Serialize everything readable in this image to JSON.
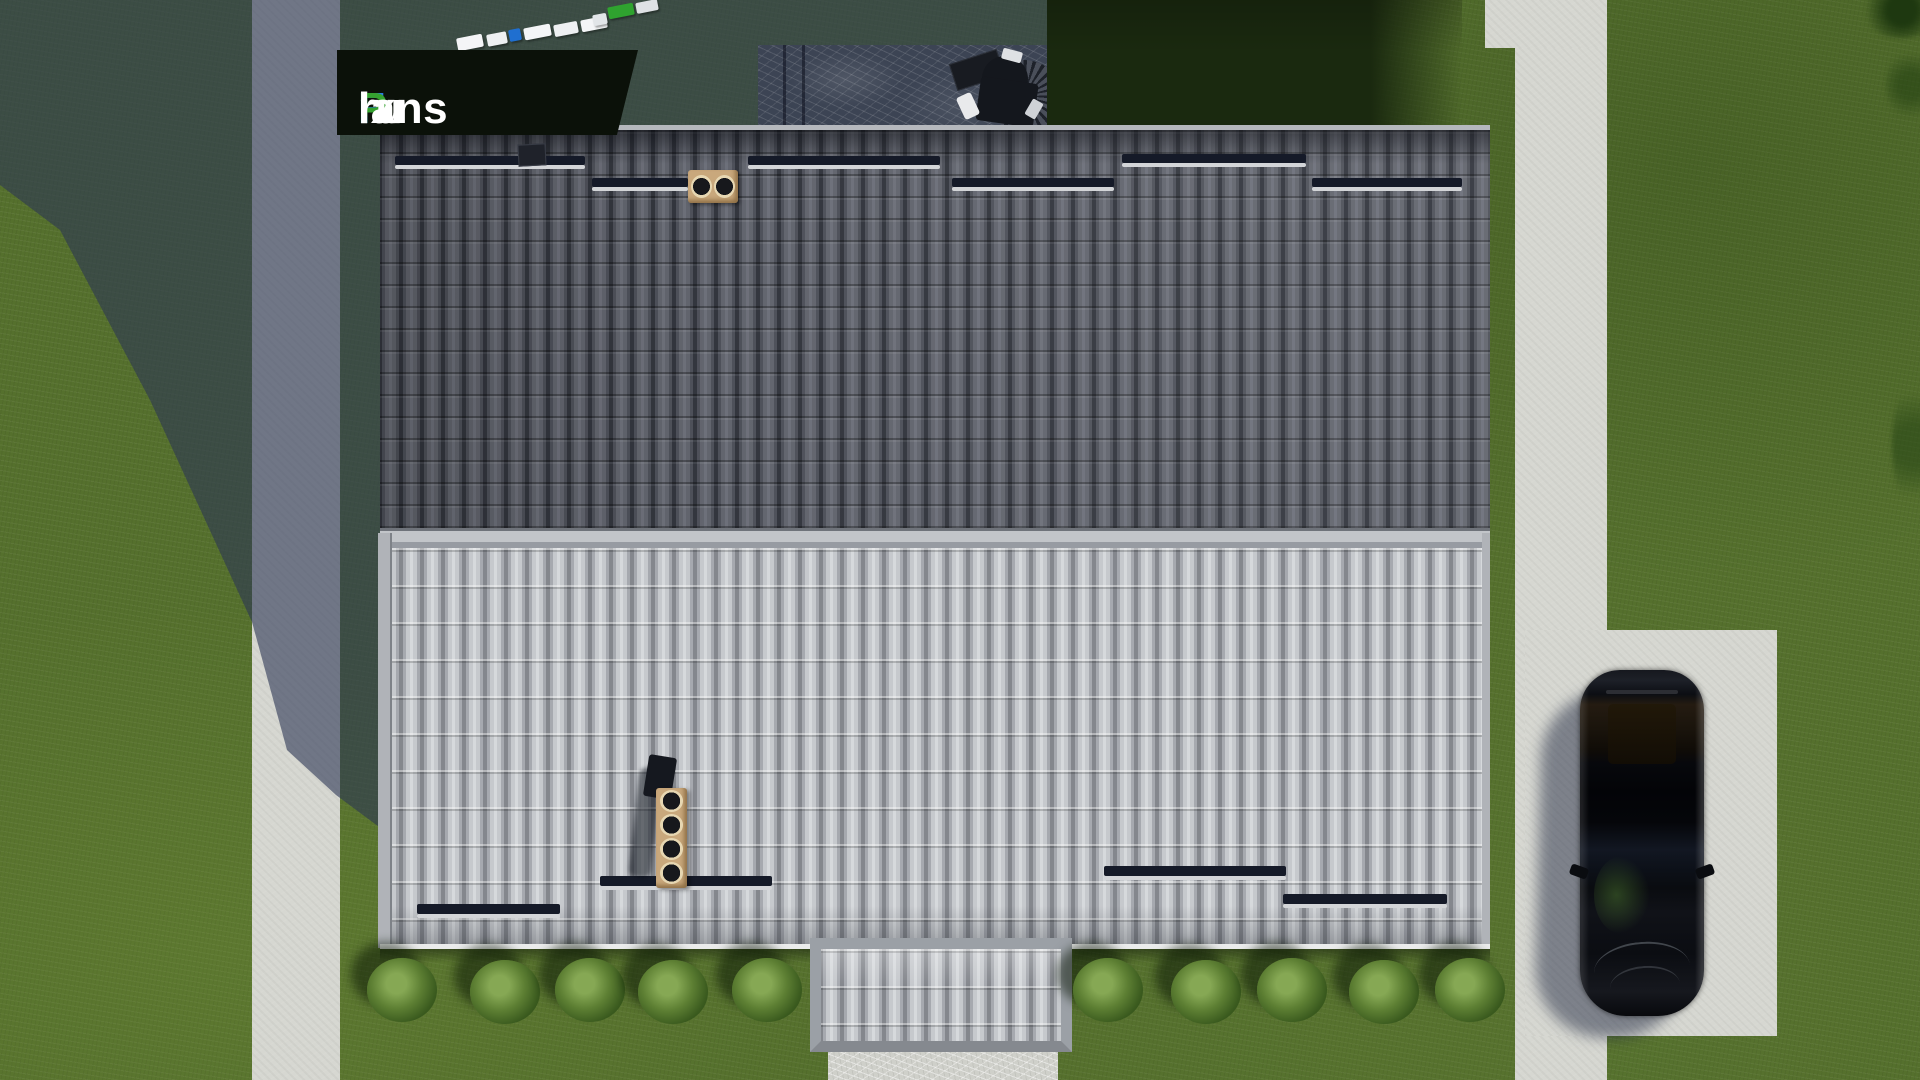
{
  "watermark": {
    "text": "FixPlans.ru",
    "segments": [
      {
        "text": "F",
        "color": "#2b7de0"
      },
      {
        "text": "ix",
        "color": "#ffffff"
      },
      {
        "text": "P",
        "color": "#35a22f"
      },
      {
        "text": "lans",
        "color": "#ffffff"
      },
      {
        "text": ".",
        "color": "#2b7de0"
      },
      {
        "text": "ru",
        "color": "#ffffff"
      }
    ],
    "plate_color": "#0b1109"
  },
  "scene": {
    "view": "top-down 3D render of house roof with yard, paths, car and shrubs",
    "colors": {
      "grass": "#55702d",
      "concrete": "#d6d7d1",
      "roof_upper_tiles": "#45484f",
      "roof_lower_tiles": "#a8abb1",
      "chimney_tan": "#c9a87c",
      "shadow": "rgba(44,54,84,0.6)",
      "car_body": "#0b0d12",
      "fence_blue": "#1f6fd0",
      "fence_green": "#2fa32f"
    },
    "fence_blocks": [
      {
        "x": 457,
        "y": 36,
        "w": 26,
        "h": 13,
        "color": "#f4f5f7"
      },
      {
        "x": 487,
        "y": 33,
        "w": 20,
        "h": 12,
        "color": "#eef0f2"
      },
      {
        "x": 509,
        "y": 29,
        "w": 12,
        "h": 12,
        "color": "#1f6fd0"
      },
      {
        "x": 524,
        "y": 26,
        "w": 27,
        "h": 12,
        "color": "#f4f5f7"
      },
      {
        "x": 554,
        "y": 23,
        "w": 24,
        "h": 12,
        "color": "#eef0f2"
      },
      {
        "x": 581,
        "y": 18,
        "w": 26,
        "h": 12,
        "color": "#f4f5f7"
      },
      {
        "x": 593,
        "y": 14,
        "w": 14,
        "h": 11,
        "color": "#e2e5e8"
      },
      {
        "x": 608,
        "y": 5,
        "w": 26,
        "h": 12,
        "color": "#2fa32f"
      },
      {
        "x": 636,
        "y": 1,
        "w": 22,
        "h": 11,
        "color": "#dfe2e5"
      }
    ],
    "upper_roof_rails": [
      {
        "x": 395,
        "y": 156,
        "w": 190
      },
      {
        "x": 592,
        "y": 178,
        "w": 96
      },
      {
        "x": 748,
        "y": 156,
        "w": 192
      },
      {
        "x": 952,
        "y": 178,
        "w": 162
      },
      {
        "x": 1122,
        "y": 154,
        "w": 184
      },
      {
        "x": 1312,
        "y": 178,
        "w": 150
      }
    ],
    "lower_roof_rails": [
      {
        "x": 417,
        "y": 904,
        "w": 143
      },
      {
        "x": 600,
        "y": 876,
        "w": 172
      },
      {
        "x": 1104,
        "y": 866,
        "w": 182
      },
      {
        "x": 1283,
        "y": 894,
        "w": 164
      }
    ],
    "extension_rail": {
      "x": 848,
      "y": 1006,
      "w": 184
    },
    "upper_chimney_flues": 2,
    "lower_chimney_flues": 4,
    "bushes_left": [
      {
        "x": 402,
        "y": 990
      },
      {
        "x": 505,
        "y": 992
      },
      {
        "x": 590,
        "y": 990
      },
      {
        "x": 673,
        "y": 992
      },
      {
        "x": 767,
        "y": 990
      }
    ],
    "bushes_right": [
      {
        "x": 1108,
        "y": 990
      },
      {
        "x": 1206,
        "y": 992
      },
      {
        "x": 1292,
        "y": 990
      },
      {
        "x": 1384,
        "y": 992
      },
      {
        "x": 1470,
        "y": 990
      }
    ]
  }
}
